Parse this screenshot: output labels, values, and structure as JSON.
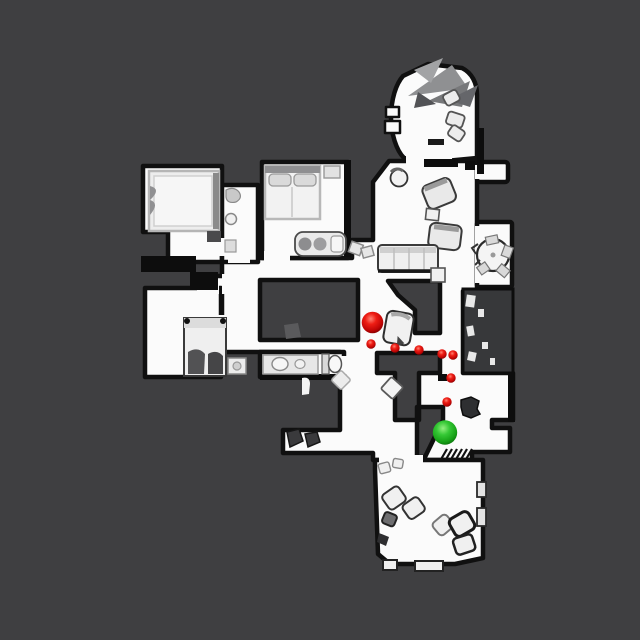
{
  "scene": {
    "description": "top-down navigation map of scanned apartment with agent path",
    "background_color": "#3f3f41",
    "floor_color": "#fbfbfb",
    "wall_color": "#101010",
    "unexplored_block_color": "#37383a"
  },
  "markers": {
    "agent": {
      "x": 372.5,
      "y": 322.5,
      "r": 10.8,
      "color": "#dd1111"
    },
    "goal": {
      "x": 445,
      "y": 432.5,
      "r": 12.2,
      "color": "#2ec82e"
    },
    "waypoint_radius": 4.7,
    "waypoints": [
      [
        371,
        344
      ],
      [
        395,
        348
      ],
      [
        419,
        350
      ],
      [
        442,
        354
      ],
      [
        453,
        355
      ],
      [
        451,
        378
      ],
      [
        447,
        402
      ]
    ]
  }
}
